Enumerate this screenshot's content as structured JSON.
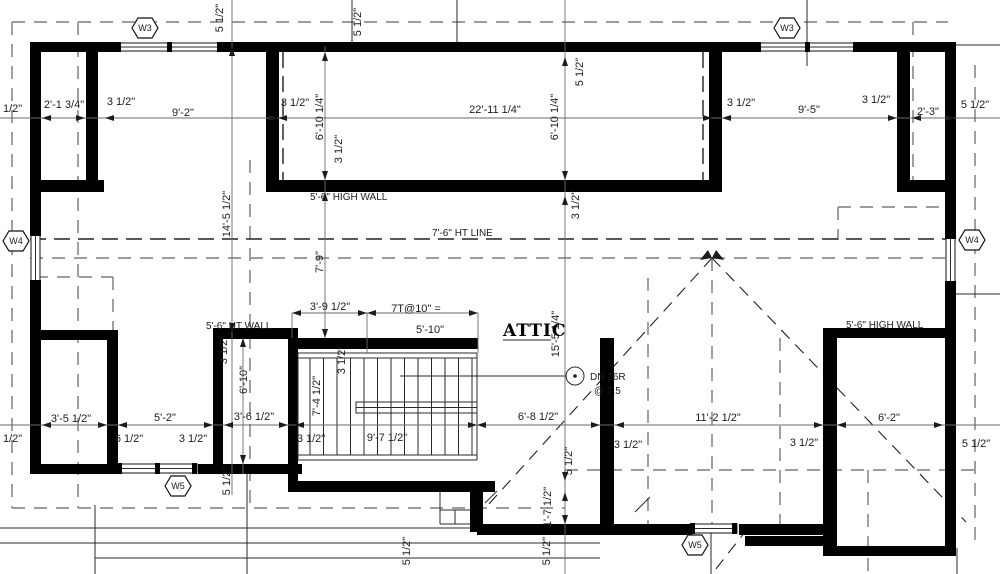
{
  "notes": {
    "room_label": "ATTIC",
    "high_wall_center": "5'-6\" HIGH WALL",
    "high_wall_right": "5'-6\" HIGH WALL",
    "ht_wall_left": "5'-6\" HT WALL",
    "ht_line": "7'-6\" HT LINE",
    "stair_treads": "7T@10\" =",
    "stair_run": "5'-10\"",
    "stair_width_dim": "3'-9 1/2\"",
    "stair_down": "DN 16R",
    "stair_down_riser": "@ 7.5"
  },
  "window_tags": {
    "w3": "W3",
    "w4": "W4",
    "w5": "W5"
  },
  "dims_h": [
    "5 1/2\"",
    "2'-1 3/4\"",
    "3 1/2\"",
    "9'-2\"",
    "3 1/2\"",
    "22'-11 1/4\"",
    "3 1/2\"",
    "9'-5\"",
    "3 1/2\"",
    "2'-3\"",
    "5 1/2\"",
    "3'-5 1/2\"",
    "6 1/2\"",
    "5'-2\"",
    "3 1/2\"",
    "3'-6 1/2\"",
    "3 1/2\"",
    "9'-7 1/2\"",
    "6'-8 1/2\"",
    "3 1/2\"",
    "11'-2 1/2\"",
    "3 1/2\"",
    "6'-2\"",
    "5 1/2\"",
    "5 1/2\""
  ],
  "dims_v": [
    "5 1/2\"",
    "5 1/2\"",
    "5 1/2\"",
    "6'-10 1/4\"",
    "3 1/2\"",
    "6'-10 1/4\"",
    "3 1/2\"",
    "14'-5 1/2\"",
    "7'-9\"",
    "3 1/2\"",
    "6'-10\"",
    "3 1/2\"",
    "7'-4 1/2\"",
    "15'-5 1/4\"",
    "5 1/2\"",
    "1'-7 1/2\"",
    "5 1/2\"",
    "5 1/2\"",
    "5 1/2\""
  ],
  "colors": {
    "walls": "#000000",
    "dash_gray": "#8f8f8f",
    "dash_dark": "#222222",
    "text": "#1c1c1c",
    "background": "#ffffff"
  }
}
